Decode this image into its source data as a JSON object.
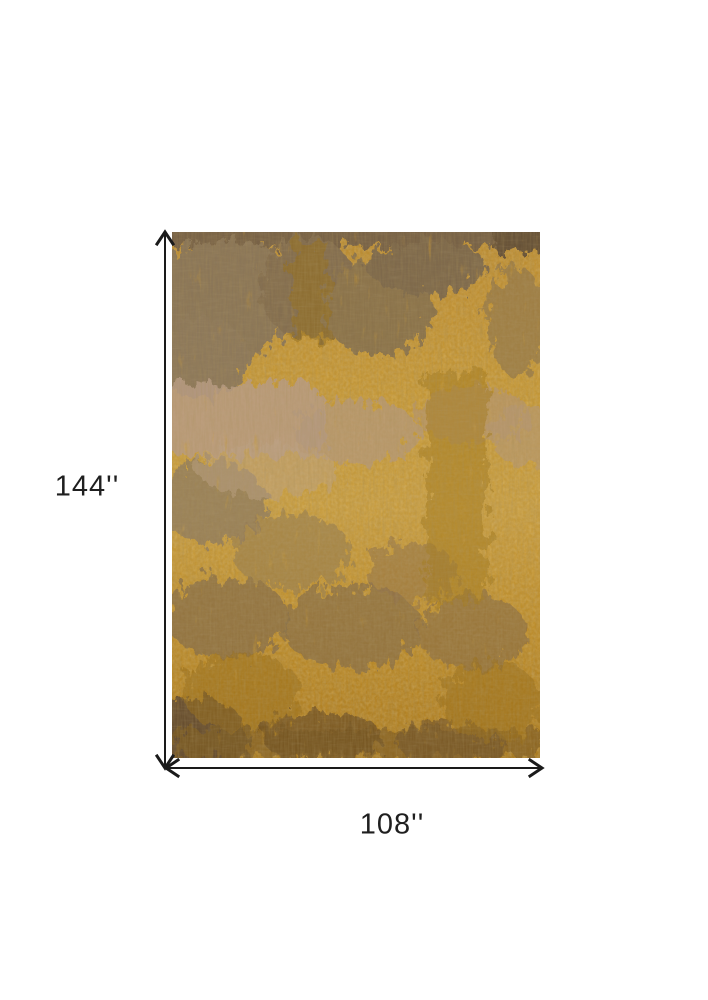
{
  "diagram": {
    "height_label": "144''",
    "width_label": "108''",
    "colors": {
      "background": "#ffffff",
      "arrow": "#1a1a1a",
      "label_text": "#1f1f1f",
      "rug_base": "#c39233",
      "rug_gray_accent": "#85735c",
      "rug_rose_accent": "#b89c86",
      "rug_amber_accent": "#9a6f1e",
      "rug_dark_corner": "#5f4a30"
    }
  }
}
